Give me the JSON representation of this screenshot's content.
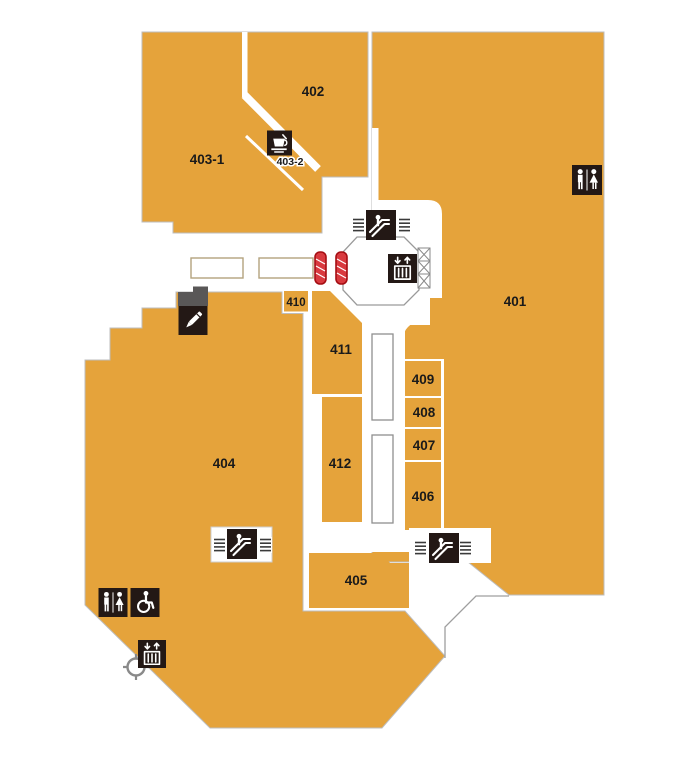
{
  "map": {
    "background_color": "#ffffff",
    "zone_fill_color": "#e5a33b",
    "icon_background_color": "#231815",
    "stairs_marker_color": "#d93a3f",
    "outline_color": "#9f9f9f",
    "zones": {
      "z401": {
        "label": "401"
      },
      "z402": {
        "label": "402"
      },
      "z403_1": {
        "label": "403-1"
      },
      "z403_2": {
        "label": "403-2"
      },
      "z404": {
        "label": "404"
      },
      "z405": {
        "label": "405"
      },
      "z406": {
        "label": "406"
      },
      "z407": {
        "label": "407"
      },
      "z408": {
        "label": "408"
      },
      "z409": {
        "label": "409"
      },
      "z410": {
        "label": "410"
      },
      "z411": {
        "label": "411"
      },
      "z412": {
        "label": "412"
      }
    },
    "icons": {
      "escalator": "escalator",
      "elevator": "elevator",
      "restroom": "restroom",
      "accessible_restroom": "accessible-restroom",
      "cafe": "cafe",
      "pen_shop": "pen",
      "emergency_stairs": "stairs-marker"
    }
  }
}
